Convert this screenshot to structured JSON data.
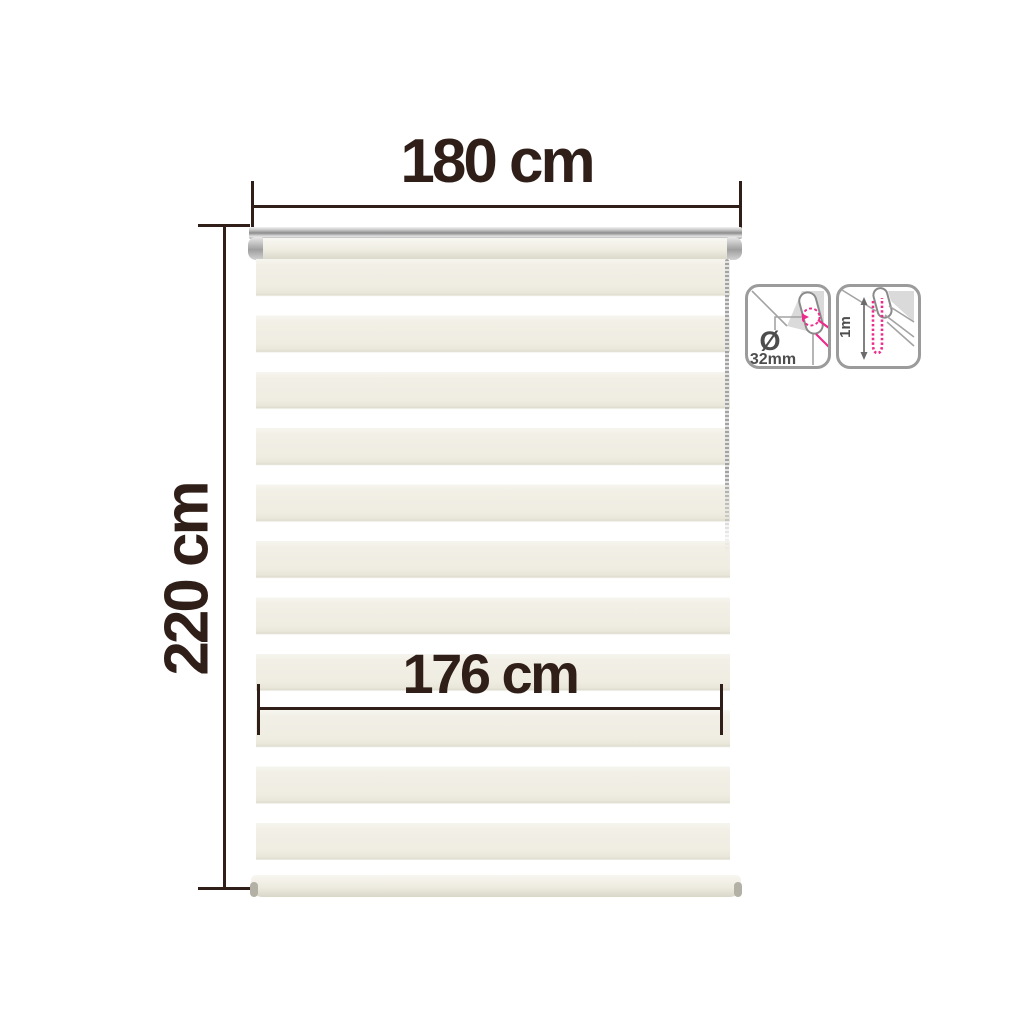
{
  "dimensions": {
    "width_label": "180 cm",
    "height_label": "220 cm",
    "fabric_width_label": "176 cm"
  },
  "spec_icons": {
    "tube_diameter": {
      "symbol": "Ø",
      "value": "32mm"
    },
    "chain_length": {
      "value": "1m"
    }
  },
  "colors": {
    "dim": "#301f18",
    "magenta": "#ec2c8a",
    "iconGray": "#4d4d4d",
    "iconLine": "#9b9b9b"
  }
}
